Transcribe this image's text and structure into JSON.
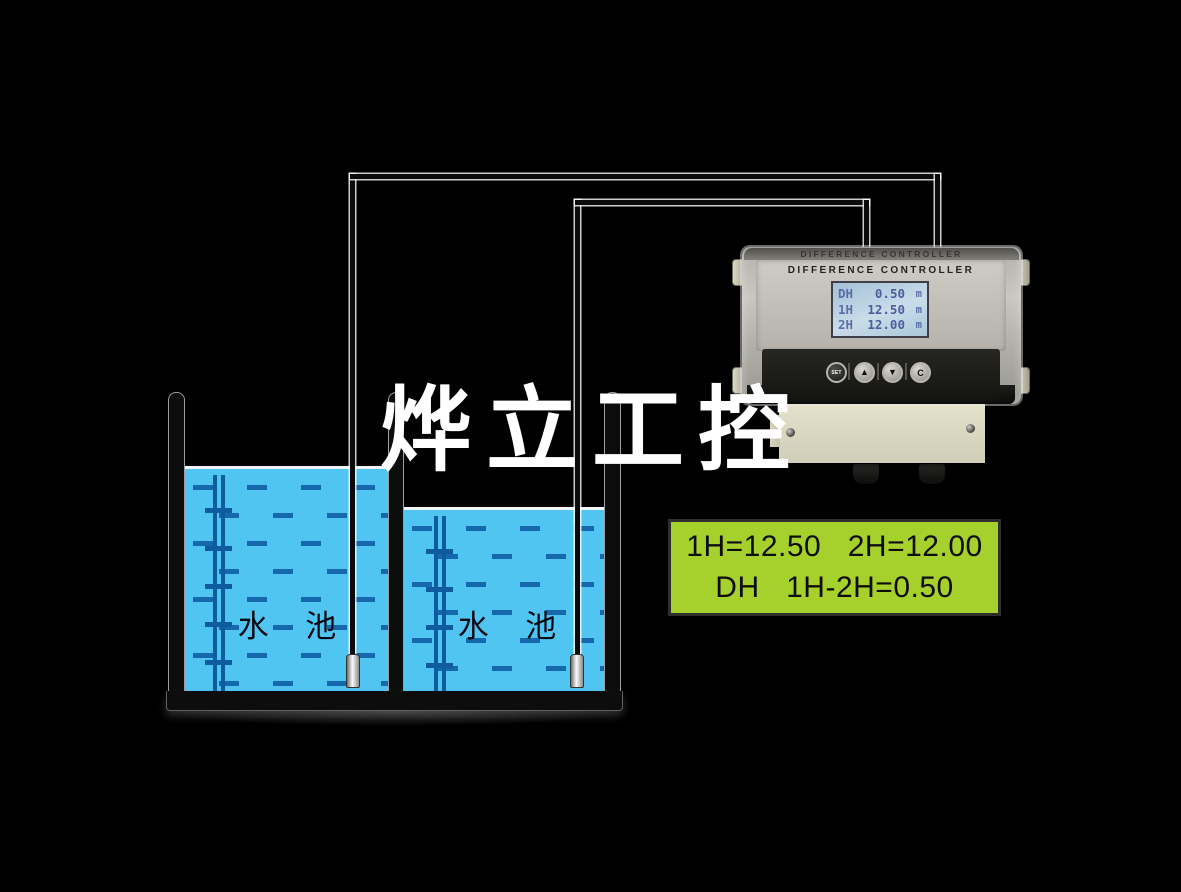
{
  "watermark": {
    "text": "烨立工控"
  },
  "tanks": {
    "tank1_label": "水 池",
    "tank2_label": "水 池"
  },
  "controller": {
    "embossed_title": "DIFFERENCE CONTROLLER",
    "title": "DIFFERENCE CONTROLLER",
    "lcd": {
      "rows": [
        {
          "label": "DH",
          "value": "0.50",
          "unit": "m"
        },
        {
          "label": "1H",
          "value": "12.50",
          "unit": "m"
        },
        {
          "label": "2H",
          "value": "12.00",
          "unit": "m"
        }
      ]
    },
    "buttons": [
      {
        "label": "SET"
      },
      {
        "label": "▲"
      },
      {
        "label": "▼"
      },
      {
        "label": "C"
      }
    ]
  },
  "readout": {
    "line1": "1H=12.50   2H=12.00",
    "line2": "DH   1H-2H=0.50"
  },
  "colors": {
    "background": "#000000",
    "water_blue": "#50c5f2",
    "wave_dash_blue": "#1568ac",
    "readout_green": "#a6d02b",
    "lcd_background": "#b9d0e0",
    "lcd_text_blue": "#4a5e9e",
    "plate_beige": "#ddd9c3"
  }
}
